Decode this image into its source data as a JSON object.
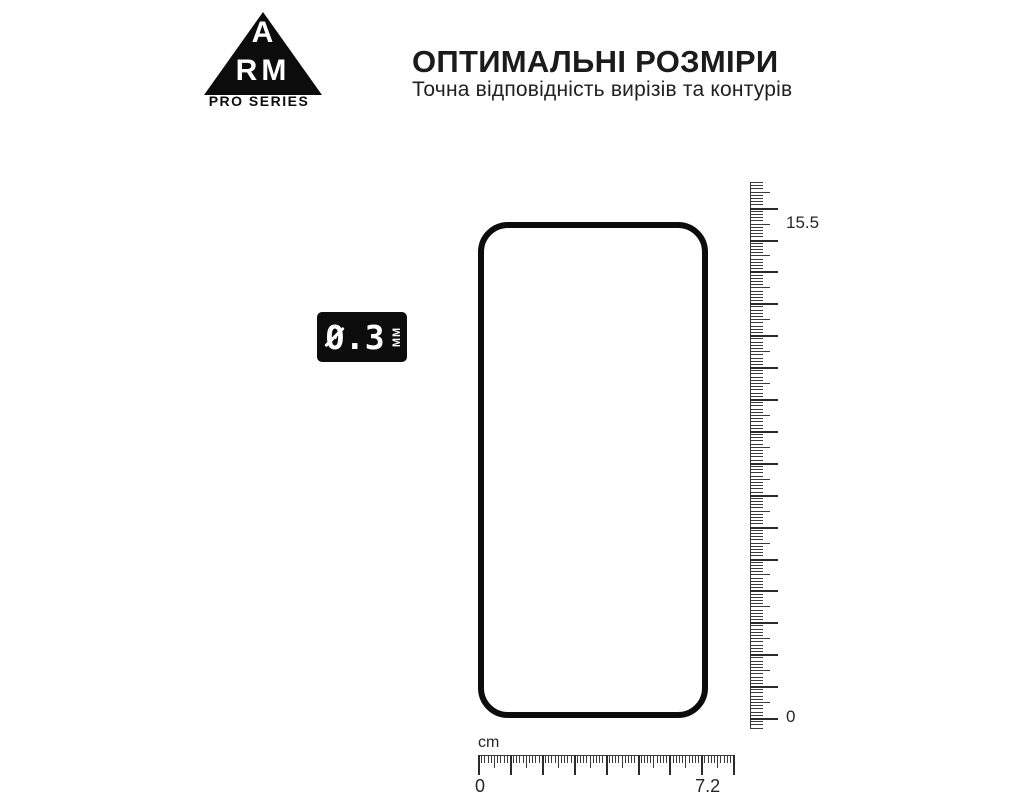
{
  "branding": {
    "logo_letter_top": "A",
    "logo_letters_bottom": "RM",
    "logo_subtext": "PRO SERIES"
  },
  "header": {
    "title": "ОПТИМАЛЬНІ РОЗМІРИ",
    "subtitle": "Точна відповідність вирізів та контурів"
  },
  "thickness_badge": {
    "value": "0.3",
    "unit": "ММ"
  },
  "rulers": {
    "vertical": {
      "unit": "cm",
      "max_label": "15.5",
      "zero_label": "0",
      "length_cm": 15.5,
      "px_per_mm": 3.19,
      "mm_min": -3,
      "mm_max": 168,
      "zero_px": 718
    },
    "horizontal": {
      "unit_label": "cm",
      "zero_label": "0",
      "max_label": "7.2",
      "length_cm": 7.2,
      "px_per_mm": 3.19,
      "mm_min": 0,
      "mm_max": 80,
      "max_mark_mm": 72
    }
  },
  "colors": {
    "ink": "#0c0c0c",
    "tick": "#3a3a3a",
    "label": "#262626",
    "background": "#ffffff"
  }
}
